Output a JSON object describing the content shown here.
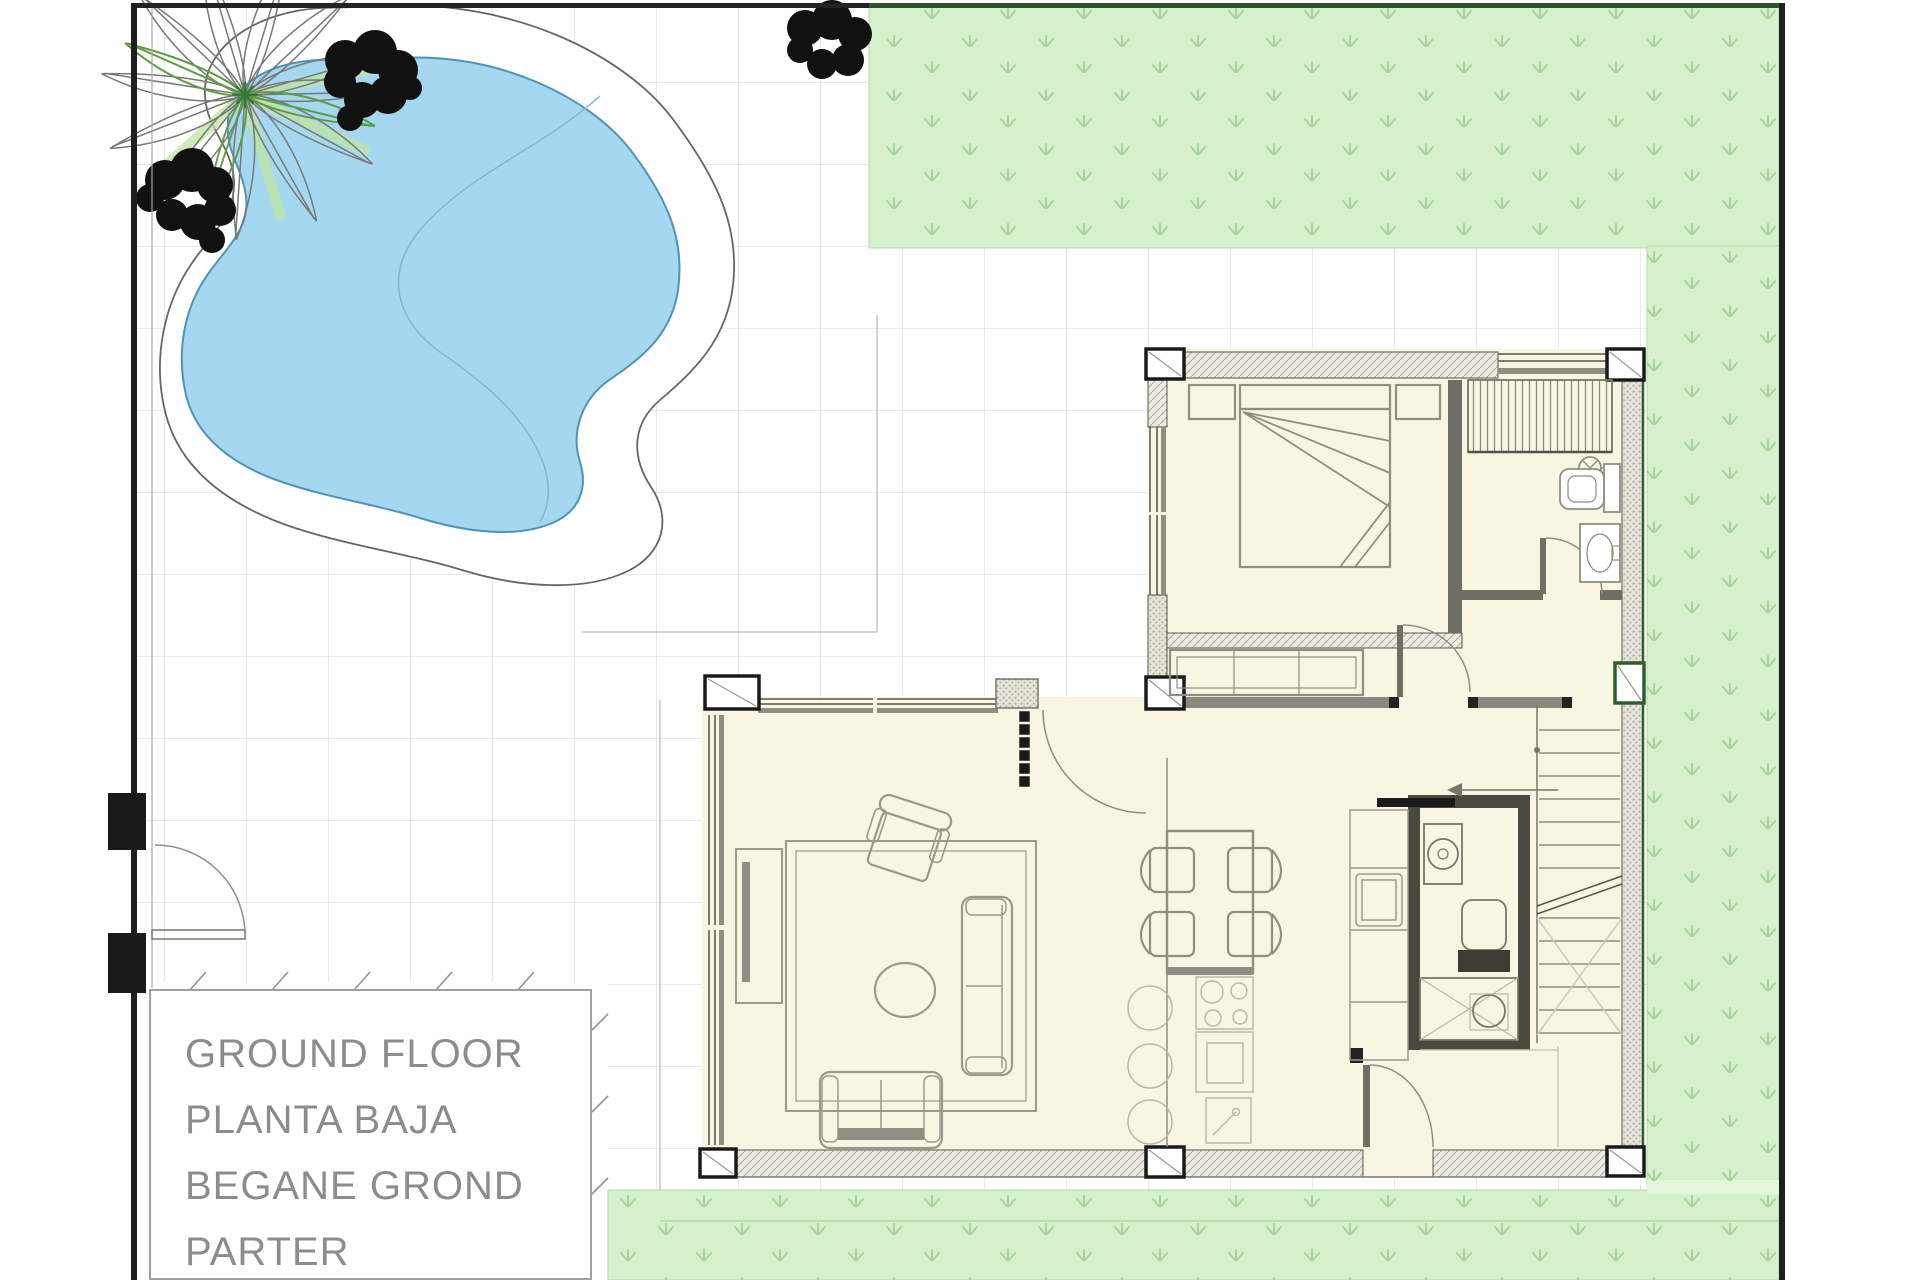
{
  "title_block": {
    "labels": [
      "GROUND FLOOR",
      "PLANTA BAJA",
      "BEGANE GROND",
      "PARTER"
    ]
  },
  "colors": {
    "pool_water": "#a5d8f0",
    "pool_water_outline": "#4e93b8",
    "pool_divider": "#7fb6d2",
    "deck_outline": "#666666",
    "grass_fill": "#d5f1cc",
    "grass_tuft": "#a6d29b",
    "grass_top_border": "#2f5130",
    "paving_line": "#dcdcdc",
    "paving_joint": "#c7c6c0",
    "room_fill": "#f8f6e2",
    "wall_hatch_bg": "#eceae0",
    "wall_edge": "#55544b",
    "pillar_black": "#1a1a1a",
    "pillar_green": "#2e5c2e",
    "furniture_line": "#8e8e82",
    "fixture_dark": "#3c3b34",
    "site_border": "#1f1f1f",
    "text_gray": "#8c8c8c"
  }
}
